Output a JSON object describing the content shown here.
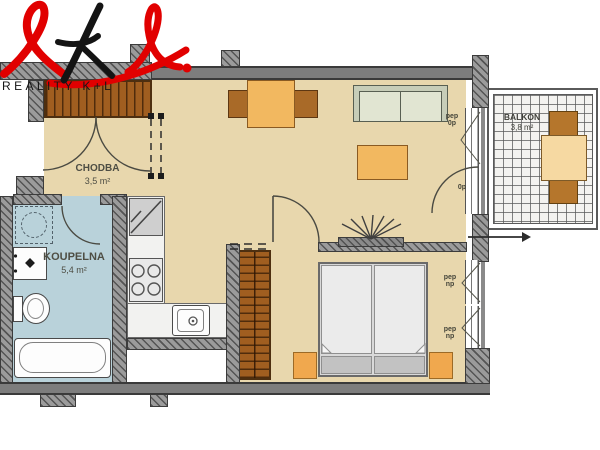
{
  "logo": {
    "brand": "REALITY K+L",
    "script_color_red": "#e10000",
    "script_color_black": "#141414"
  },
  "rooms": {
    "hallway": {
      "name": "CHODBA",
      "area": "3,5 m²"
    },
    "bathroom": {
      "name": "KOUPELNA",
      "area": "5,4 m²"
    },
    "balcony": {
      "name": "BALKON",
      "area": "3,8 m²"
    }
  },
  "annotations": {
    "living_window": {
      "line1": "pep",
      "line2": "0p"
    },
    "balcony_door": {
      "line1": "0p"
    },
    "bedroom_window_1": {
      "line1": "pep",
      "line2": "np"
    },
    "bedroom_window_2": {
      "line1": "pep",
      "line2": "np"
    }
  },
  "colors": {
    "floor_beige": "#e8d7ad",
    "bathroom_blue": "#b9d2da",
    "wall_gray": "#7d7d7d",
    "wood_brown": "#a05e20",
    "furniture_orange": "#f2b860",
    "sofa_green": "#e1e5d2",
    "logo_red": "#e10000",
    "logo_black": "#141414"
  }
}
